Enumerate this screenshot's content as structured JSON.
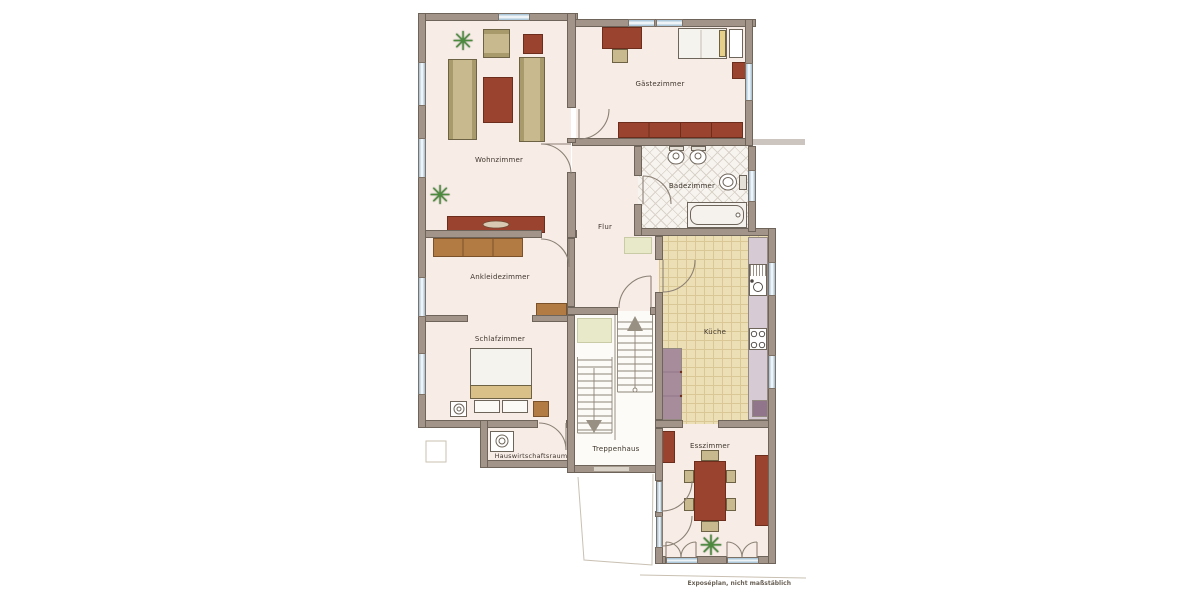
{
  "rooms": {
    "wohnzimmer": {
      "label": "Wohnzimmer"
    },
    "gaestezimmer": {
      "label": "Gästezimmer"
    },
    "badezimmer": {
      "label": "Badezimmer"
    },
    "flur": {
      "label": "Flur"
    },
    "ankleidezimmer": {
      "label": "Ankleidezimmer"
    },
    "schlafzimmer": {
      "label": "Schlafzimmer"
    },
    "kueche": {
      "label": "Küche"
    },
    "treppenhaus": {
      "label": "Treppenhaus"
    },
    "hauswirtschaftsraum": {
      "label": "Hauswirtschaftsraum"
    },
    "esszimmer": {
      "label": "Esszimmer"
    }
  },
  "footer": {
    "note": "Exposéplan, nicht maßstäblich"
  },
  "icons": {
    "plant": "✳"
  },
  "colors": {
    "wall": "#a3948a",
    "wallEdge": "#6f6459",
    "floor": "#f8ece7",
    "stairFloor": "#fcfbf7",
    "window": "#adc9db",
    "windowLight": "#edf3f7",
    "frame": "#7d7265",
    "woodLight": "#c9b98f",
    "woodShade": "#a89a6b",
    "woodEdge": "#6e6244",
    "red": "#9a4430",
    "redEdge": "#6d2d1d",
    "brown": "#b17b43",
    "brownEdge": "#7a5128",
    "kitchenFloor": "#eddfb5",
    "kitchenTile": "#d9c795",
    "counter": "#d6cad5",
    "counterEdge": "#948a82",
    "cabinet": "#a78d9b",
    "cabinetDark": "#91758a",
    "bathFloor": "#f7f4f0",
    "bathLine": "#d9d2c9",
    "mat": "#e7e9c9",
    "fixtureEdge": "#6e655a",
    "ink": "#3f372d",
    "inkSoft": "#6a6156",
    "faint": "#c9c0b2",
    "plant": "#4c8a3e",
    "plantDark": "#2e5c26",
    "pillow": "#e7d08a",
    "pillowWhite": "#fbfaf6",
    "blanket": "#d9c089",
    "stair": "#8d8478"
  }
}
